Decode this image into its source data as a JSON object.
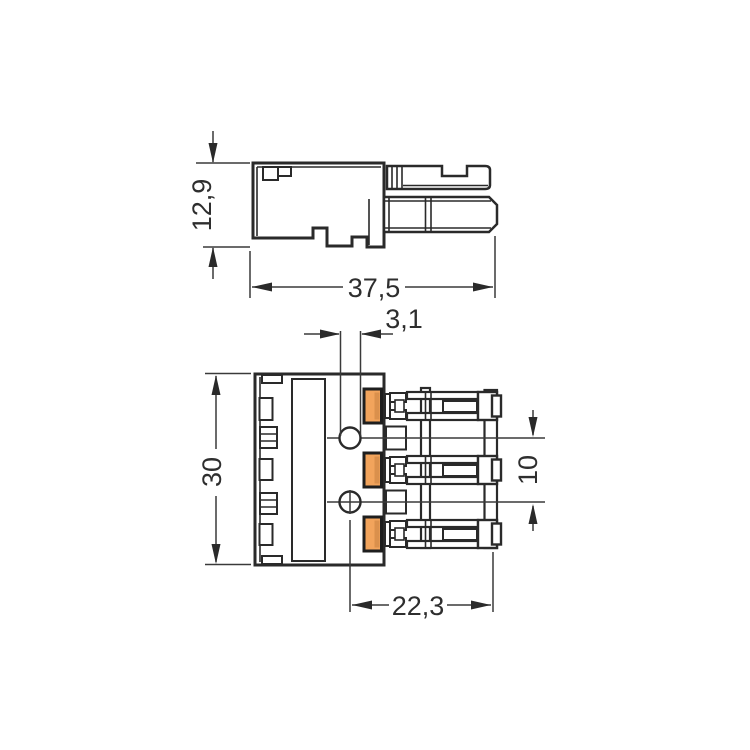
{
  "page": {
    "background_color": "#ffffff"
  },
  "drawing": {
    "type": "technical-dimension-drawing",
    "unit_hint": "mm",
    "accent_color": "#f2a45c",
    "accent_shade": "#d68d49",
    "line_color": "#2a2a2a",
    "side_view": {
      "height_label": "12,9",
      "width_label": "37,5"
    },
    "front_view": {
      "hole_diameter_label": "3,1",
      "height_label": "30",
      "pole_pitch_label": "10",
      "width_label": "22,3"
    }
  }
}
